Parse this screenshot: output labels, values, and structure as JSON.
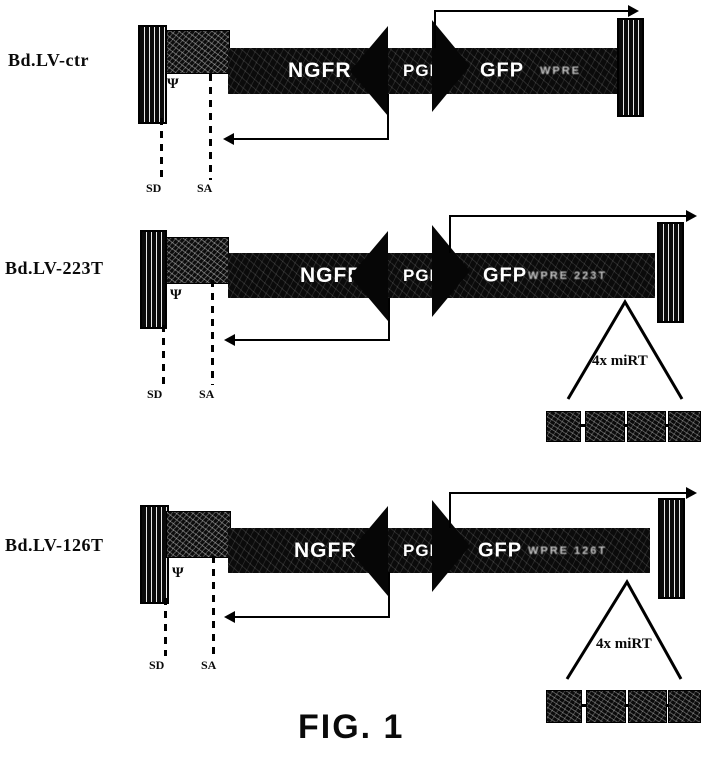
{
  "figure": {
    "caption": "FIG. 1"
  },
  "constructs": [
    {
      "name": "Bd.LV-ctr",
      "psi": "Ψ",
      "sd": "SD",
      "sa": "SA",
      "genes": {
        "ngfr": "NGFR",
        "pgk": "PGK",
        "gfp": "GFP",
        "right_label": "WPRE"
      }
    },
    {
      "name": "Bd.LV-223T",
      "psi": "Ψ",
      "sd": "SD",
      "sa": "SA",
      "genes": {
        "ngfr": "NGFR",
        "pgk": "PGK",
        "gfp": "GFP",
        "right_label": "WPRE 223T"
      },
      "mirt": {
        "label": "4x miRT",
        "box_count": 4
      }
    },
    {
      "name": "Bd.LV-126T",
      "psi": "Ψ",
      "sd": "SD",
      "sa": "SA",
      "genes": {
        "ngfr": "NGFR",
        "pgk": "PGK",
        "gfp": "GFP",
        "right_label": "WPRE 126T"
      },
      "mirt": {
        "label": "4x miRT",
        "box_count": 4
      }
    }
  ]
}
